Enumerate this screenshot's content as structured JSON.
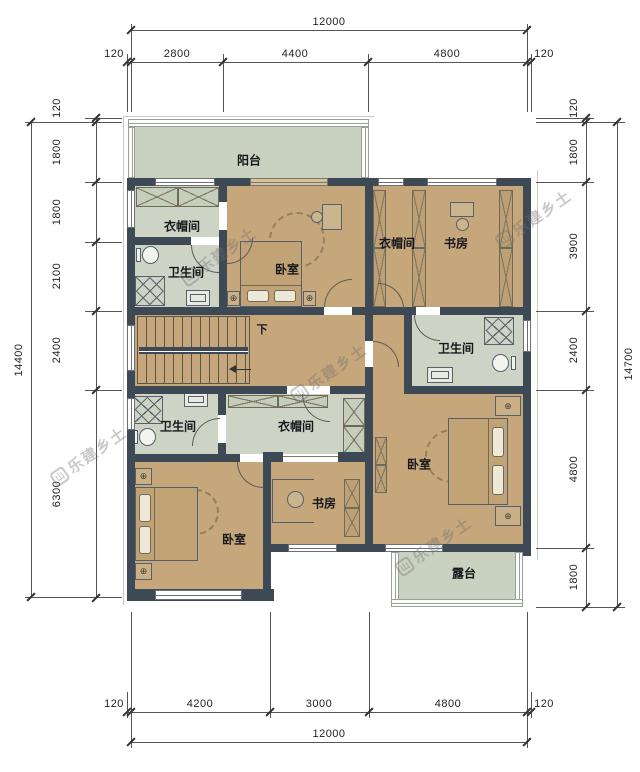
{
  "dimensions": {
    "top": {
      "overall": "12000",
      "segments": [
        "120",
        "2800",
        "4400",
        "4800",
        "120"
      ]
    },
    "bottom": {
      "overall": "12000",
      "segments": [
        "120",
        "4200",
        "3000",
        "4800",
        "120"
      ]
    },
    "left": {
      "overall": "14400",
      "segments": [
        "120",
        "1800",
        "1800",
        "2100",
        "2400",
        "6300"
      ]
    },
    "right": {
      "overall": "14700",
      "segments": [
        "120",
        "1800",
        "3900",
        "2400",
        "4800",
        "1800"
      ]
    }
  },
  "rooms": {
    "balcony": {
      "label": "阳台"
    },
    "cloakroom_nw": {
      "label": "衣帽间"
    },
    "bathroom_nw": {
      "label": "卫生间"
    },
    "bedroom_north": {
      "label": "卧室"
    },
    "cloakroom_ne": {
      "label": "衣帽间"
    },
    "study_ne": {
      "label": "书房"
    },
    "bathroom_east": {
      "label": "卫生间"
    },
    "bathroom_west": {
      "label": "卫生间"
    },
    "cloakroom_south": {
      "label": "衣帽间"
    },
    "bedroom_sw": {
      "label": "卧室"
    },
    "study_south": {
      "label": "书房"
    },
    "bedroom_se": {
      "label": "卧室"
    },
    "terrace": {
      "label": "露台"
    }
  },
  "stairs": {
    "down_label": "下"
  },
  "watermark": {
    "text": "乐建乡土",
    "logo": "山"
  },
  "colors": {
    "wall": "#3d4a55",
    "bedroom_floor": "#c6a67b",
    "wet_floor": "#cdd4c6",
    "outdoor_floor": "#c9d2c0",
    "dimension_line": "#555555"
  }
}
